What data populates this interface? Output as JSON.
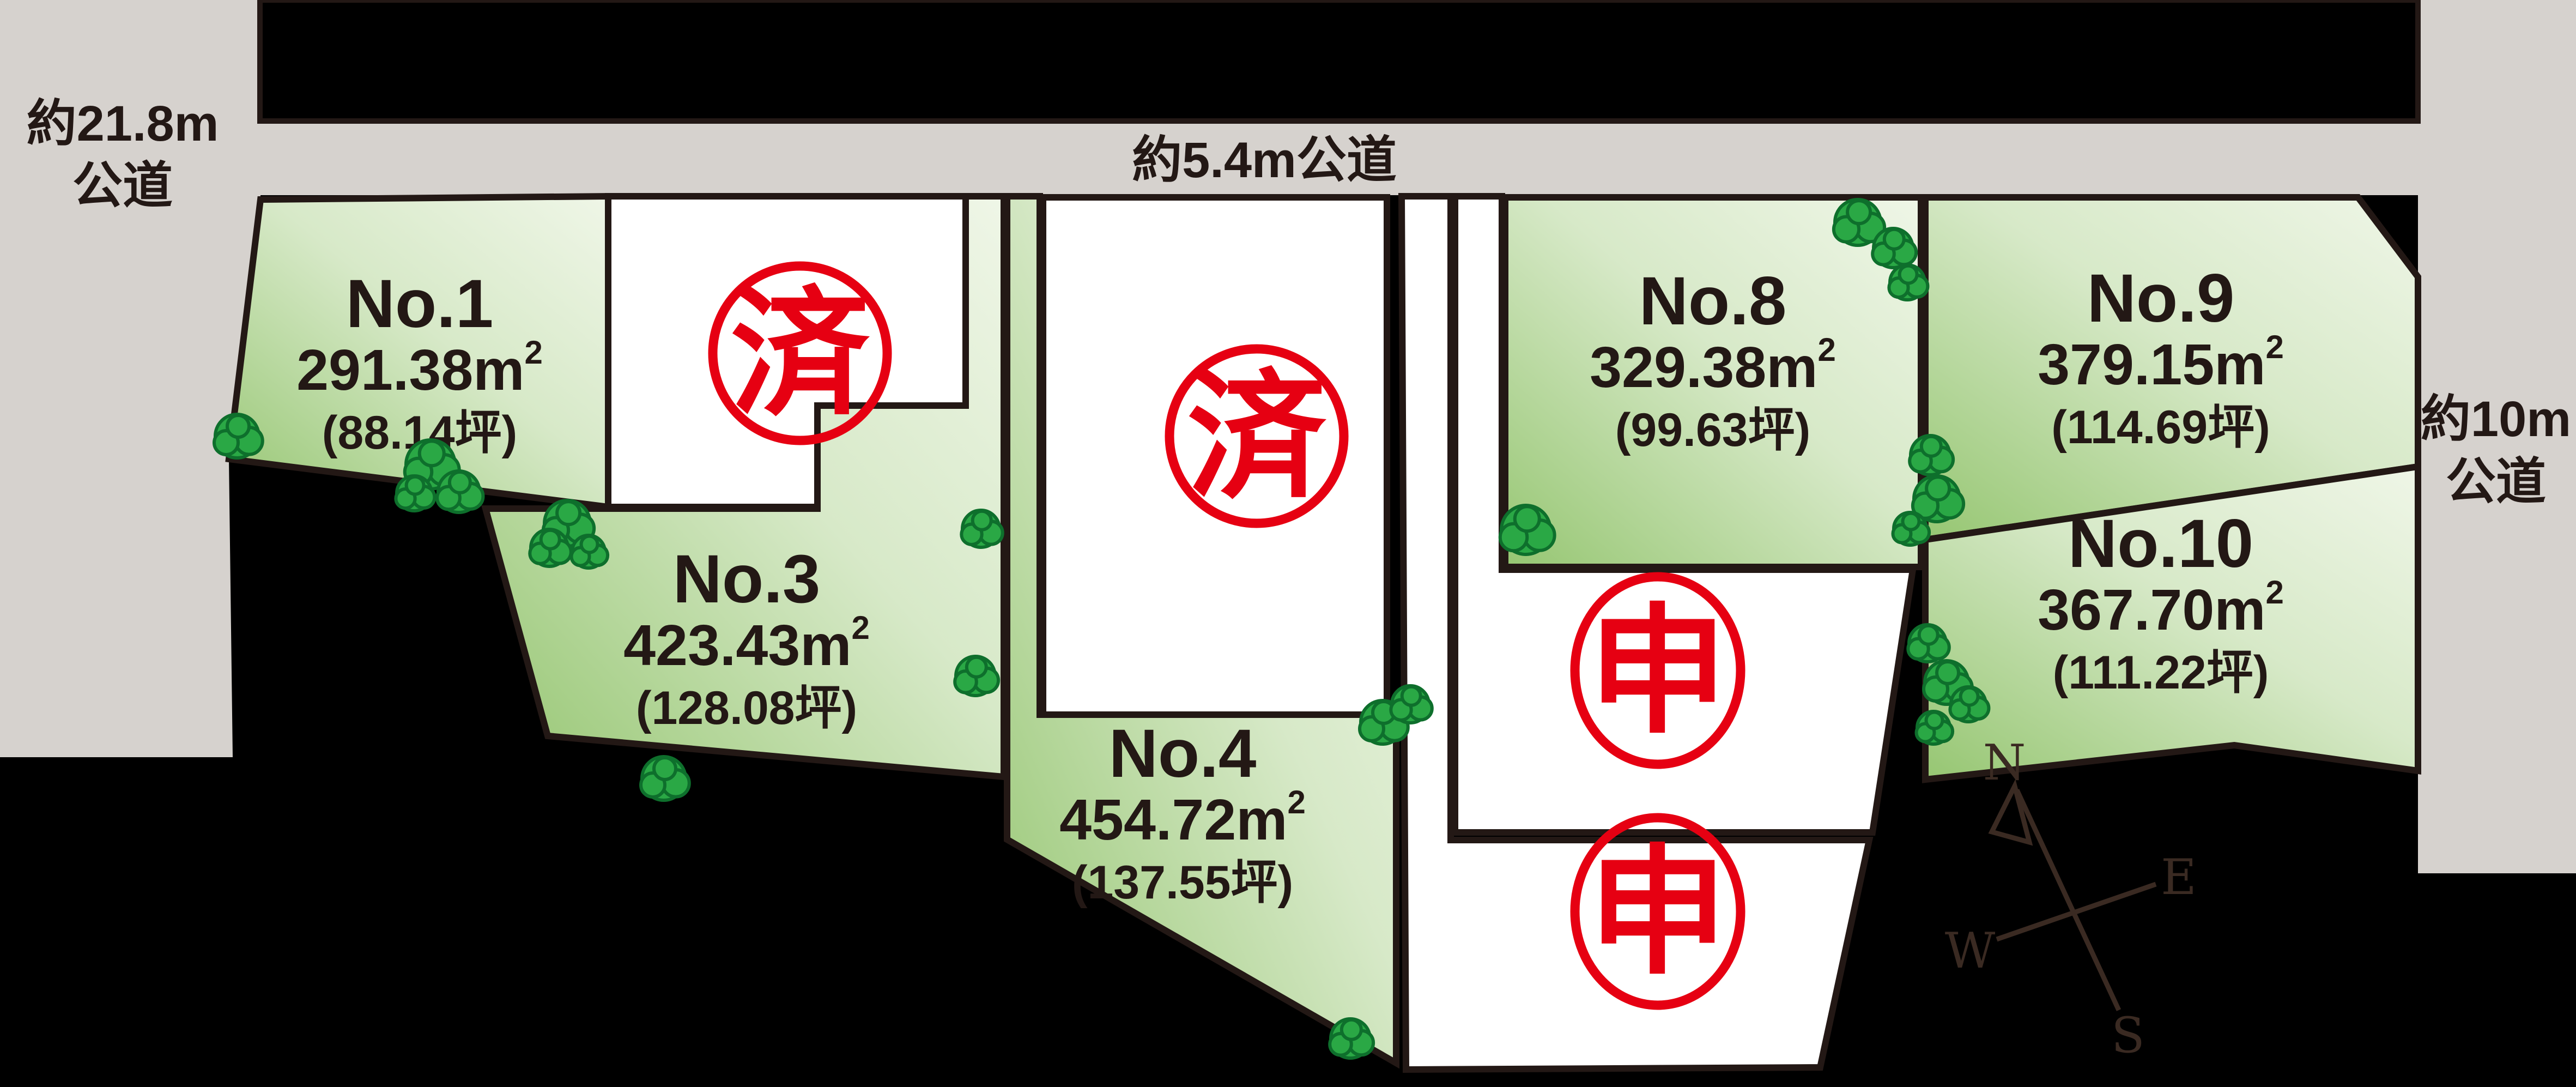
{
  "map": {
    "roads": {
      "left": {
        "line1": "約21.8m",
        "line2": "公道"
      },
      "top": {
        "label": "約5.4m公道"
      },
      "right": {
        "line1": "約10m",
        "line2": "公道"
      }
    },
    "sup2": "2",
    "lots": [
      {
        "label": "No.1",
        "area": "291.38m",
        "tsubo": "(88.14坪)"
      },
      {
        "label": "No.3",
        "area": "423.43m",
        "tsubo": "(128.08坪)"
      },
      {
        "label": "No.4",
        "area": "454.72m",
        "tsubo": "(137.55坪)"
      },
      {
        "label": "No.8",
        "area": "329.38m",
        "tsubo": "(99.63坪)"
      },
      {
        "label": "No.9",
        "area": "379.15m",
        "tsubo": "(114.69坪)"
      },
      {
        "label": "No.10",
        "area": "367.70m",
        "tsubo": "(111.22坪)"
      }
    ],
    "white_lots": [
      {
        "stamp": "済"
      },
      {
        "stamp": "済"
      },
      {
        "stamp": "申"
      },
      {
        "stamp": "申"
      }
    ],
    "compass": {
      "n": "N",
      "e": "E",
      "s": "S",
      "w": "W"
    },
    "colors": {
      "background": "#000000",
      "road_gray": "#d6d2ce",
      "outline": "#231815",
      "stamp_red": "#e60012",
      "green_dark": "#96c672",
      "green_light": "#eff6e7",
      "tree_green": "#2aa845",
      "white": "#ffffff"
    }
  }
}
